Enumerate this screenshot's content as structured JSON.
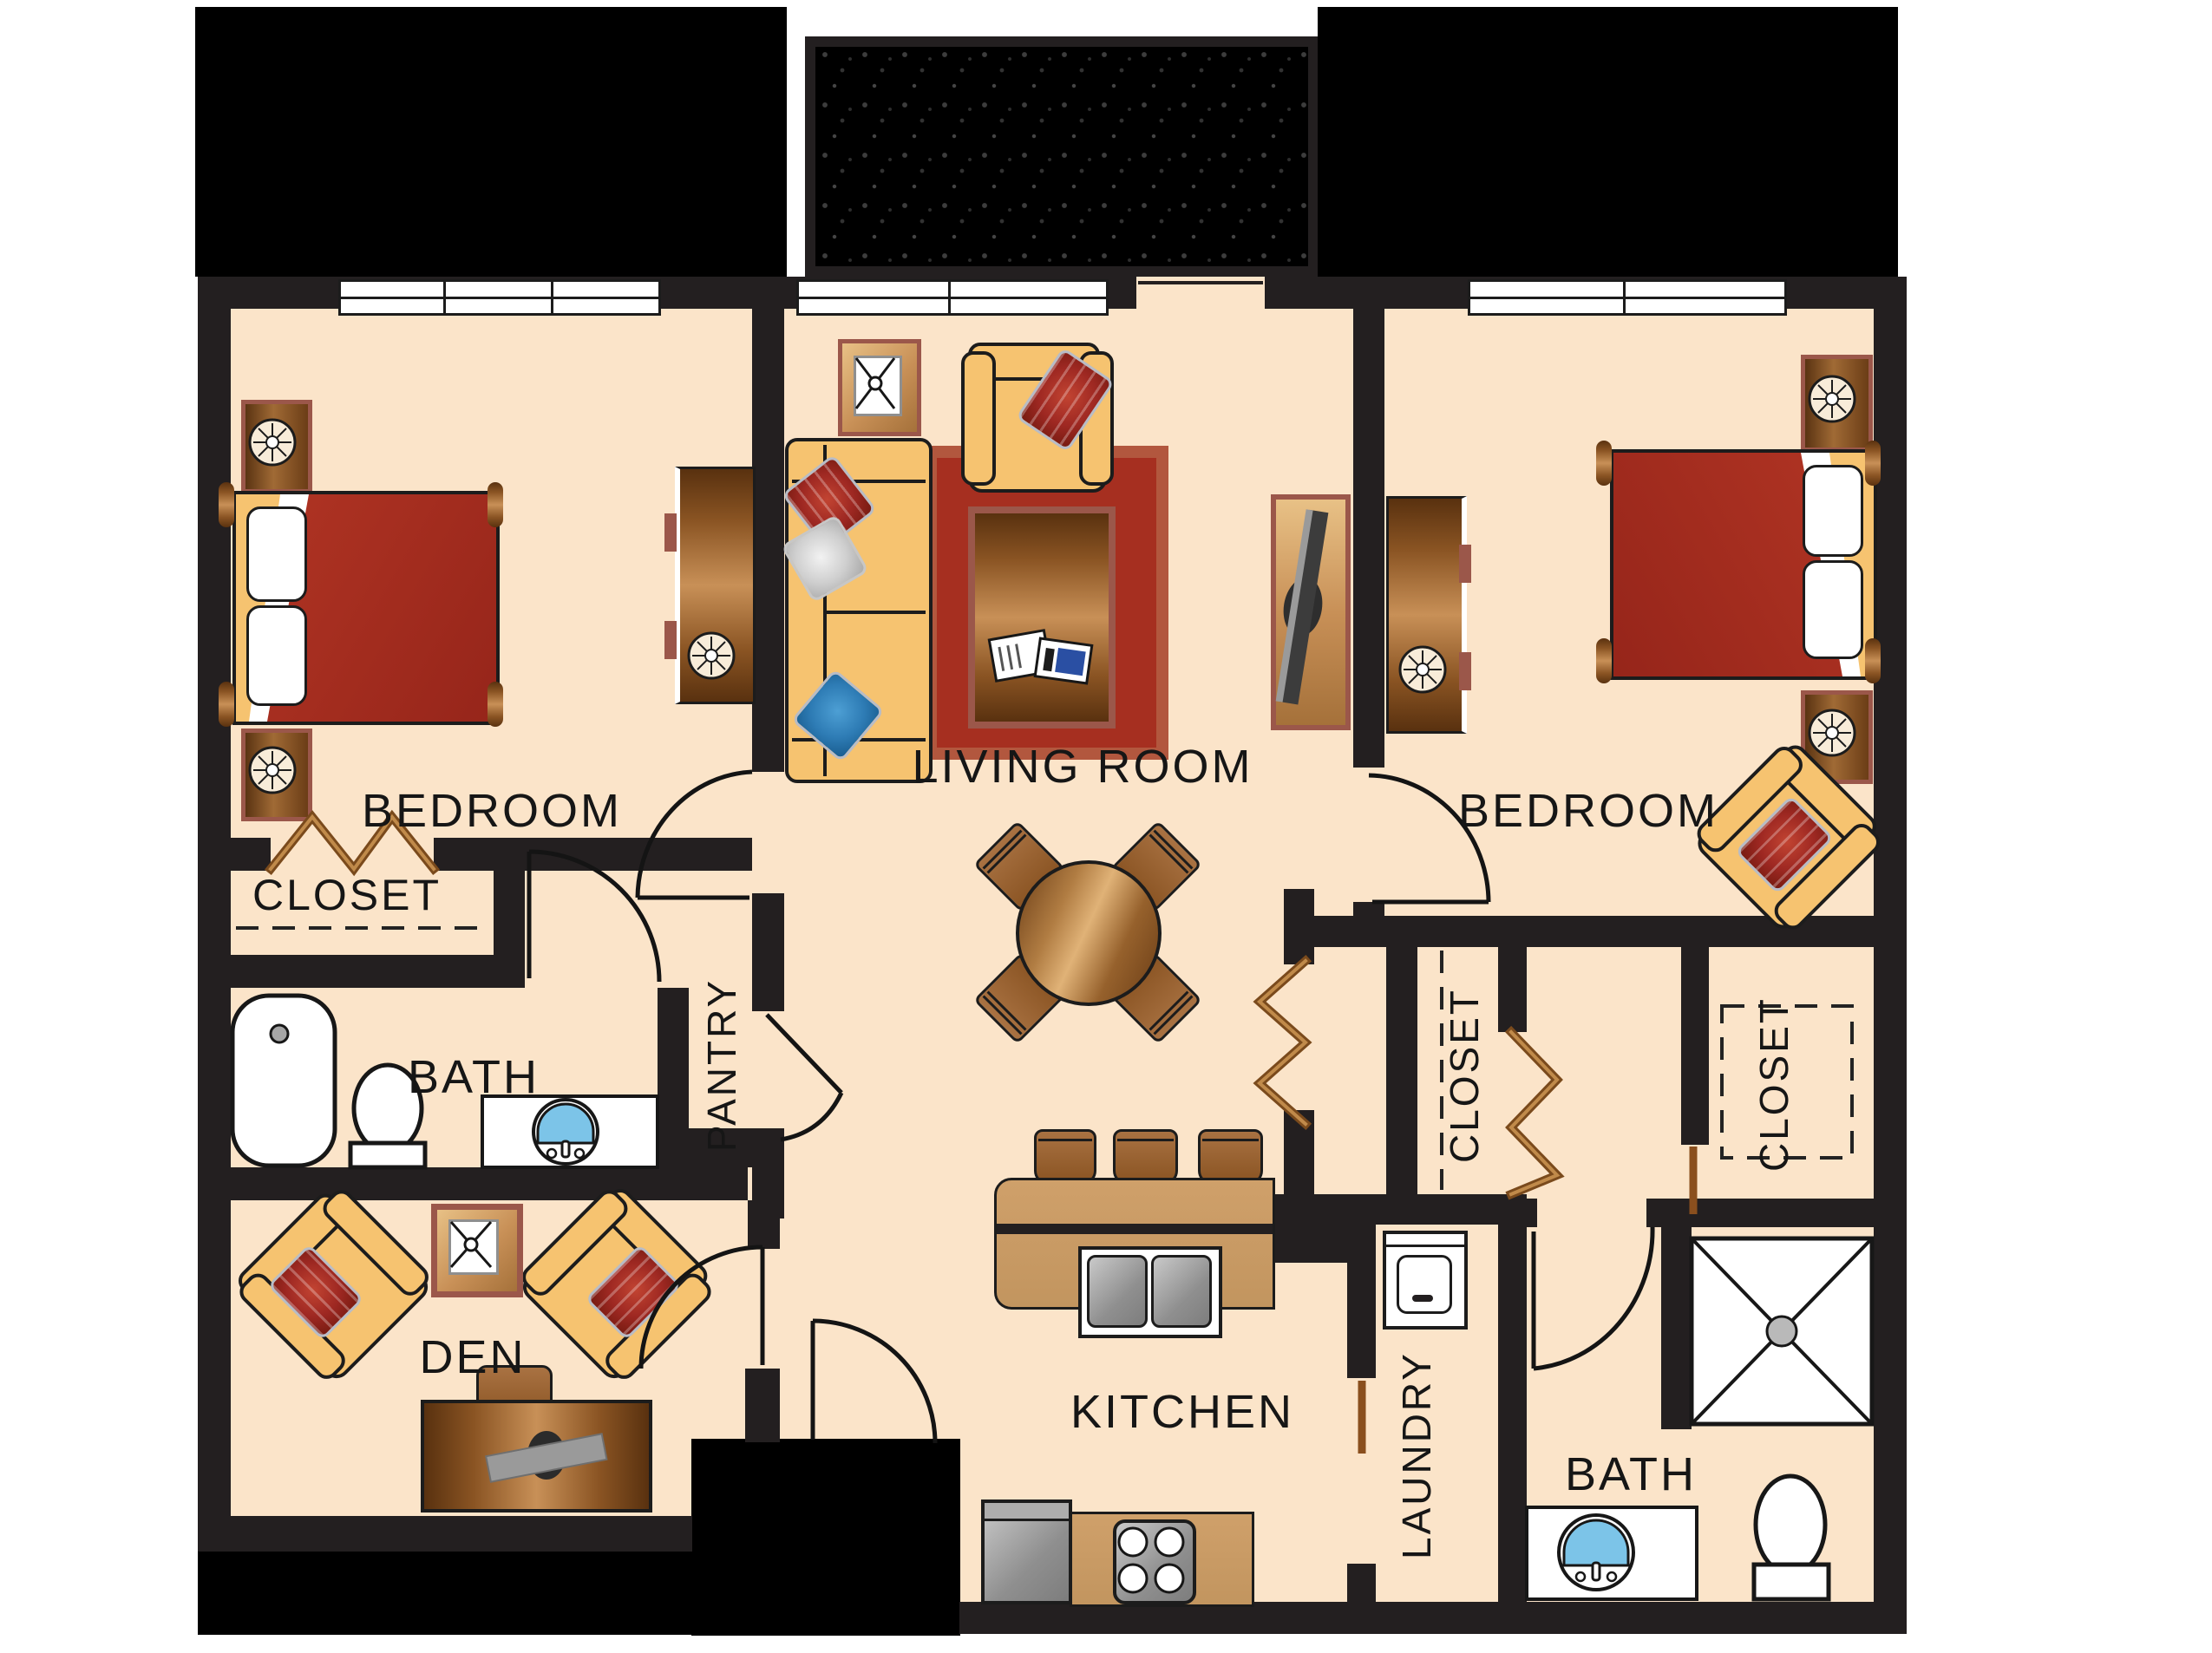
{
  "title": "Two Bedroom Apartment Floor Plan",
  "rooms": {
    "bedroom_left": {
      "label": "BEDROOM"
    },
    "living_room": {
      "label": "LIVING ROOM"
    },
    "bedroom_right": {
      "label": "BEDROOM"
    },
    "closet_bedroom_left": {
      "label": "CLOSET"
    },
    "bath_left": {
      "label": "BATH"
    },
    "pantry": {
      "label": "PANTRY"
    },
    "den": {
      "label": "DEN"
    },
    "kitchen": {
      "label": "KITCHEN"
    },
    "laundry": {
      "label": "LAUNDRY"
    },
    "closet_hall": {
      "label": "CLOSET"
    },
    "closet_bedroom_right": {
      "label": "CLOSET"
    },
    "bath_right": {
      "label": "BATH"
    }
  },
  "palette": {
    "floor": "#fbe4c9",
    "wall": "#231f20",
    "exterior_black": "#000000",
    "furniture_tan": "#f6c370",
    "wood_brown": "#8a5423",
    "trim_maroon": "#9b574a",
    "fabric_red": "#9e2822",
    "rug_red": "#a62f20",
    "pillow_blue": "#2e7cb5",
    "sink_blue": "#7cc4e8",
    "appliance_gray": "#9a9a9a"
  }
}
